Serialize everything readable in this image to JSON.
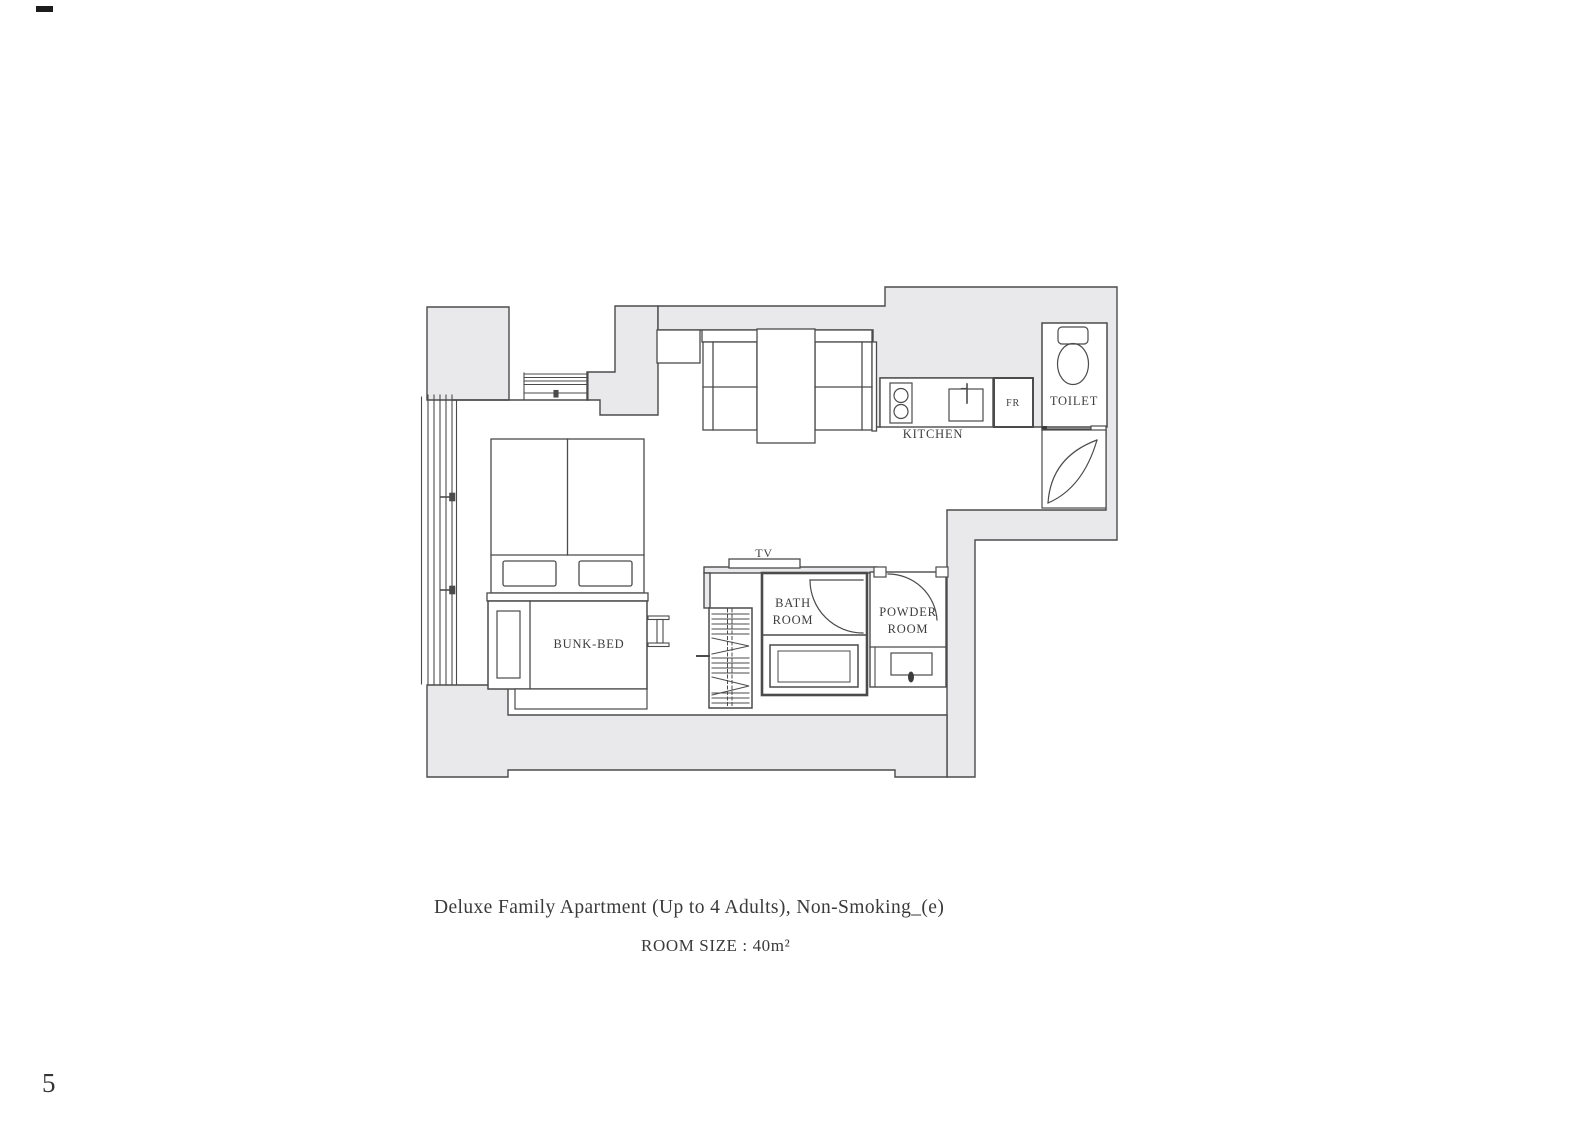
{
  "document": {
    "caption_line1": "Deluxe Family Apartment (Up to 4 Adults), Non-Smoking_(e)",
    "caption_line2": "ROOM SIZE : 40m²",
    "page_number": "5"
  },
  "floorplan": {
    "labels": {
      "kitchen": "KITCHEN",
      "fridge": "FR",
      "toilet": "TOILET",
      "tv": "TV",
      "bath_line1": "BATH",
      "bath_line2": "ROOM",
      "powder_line1": "POWDER",
      "powder_line2": "ROOM",
      "bunk_bed": "BUNK-BED"
    },
    "colors": {
      "wall_fill": "#e9e9eb",
      "line": "#4b4b4b",
      "text": "#3d3d3d"
    }
  }
}
